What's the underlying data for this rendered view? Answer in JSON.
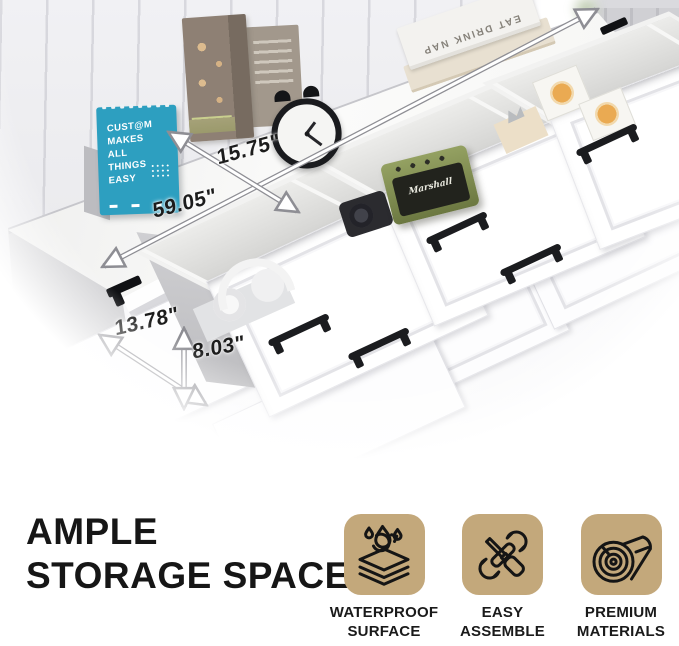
{
  "photo": {
    "calendar": {
      "lines": [
        "CUST@M",
        "MAKES",
        "ALL",
        "THINGS",
        "EASY"
      ]
    },
    "book_spine": "EAT DRINK NAP",
    "speaker_brand": "Marshall",
    "dimensions": {
      "surface_depth": "15.75\"",
      "length": "59.05\"",
      "drawer_depth": "13.78\"",
      "drawer_height": "8.03\""
    }
  },
  "heading": {
    "line1": "AMPLE",
    "line2": "STORAGE SPACE"
  },
  "features": [
    {
      "icon": "waterproof-icon",
      "label_line1": "WATERPROOF",
      "label_line2": "SURFACE"
    },
    {
      "icon": "easy-assemble-icon",
      "label_line1": "EASY",
      "label_line2": "ASSEMBLE"
    },
    {
      "icon": "premium-materials-icon",
      "label_line1": "PREMIUM",
      "label_line2": "MATERIALS"
    }
  ],
  "colors": {
    "accent_tan": "#C3A87B",
    "calendar_teal": "#2D9FC0",
    "ink": "#141414",
    "wall_gray": "#EBEBEE",
    "floor_pink": "#E8D4C8",
    "speaker_green": "#79854C"
  }
}
